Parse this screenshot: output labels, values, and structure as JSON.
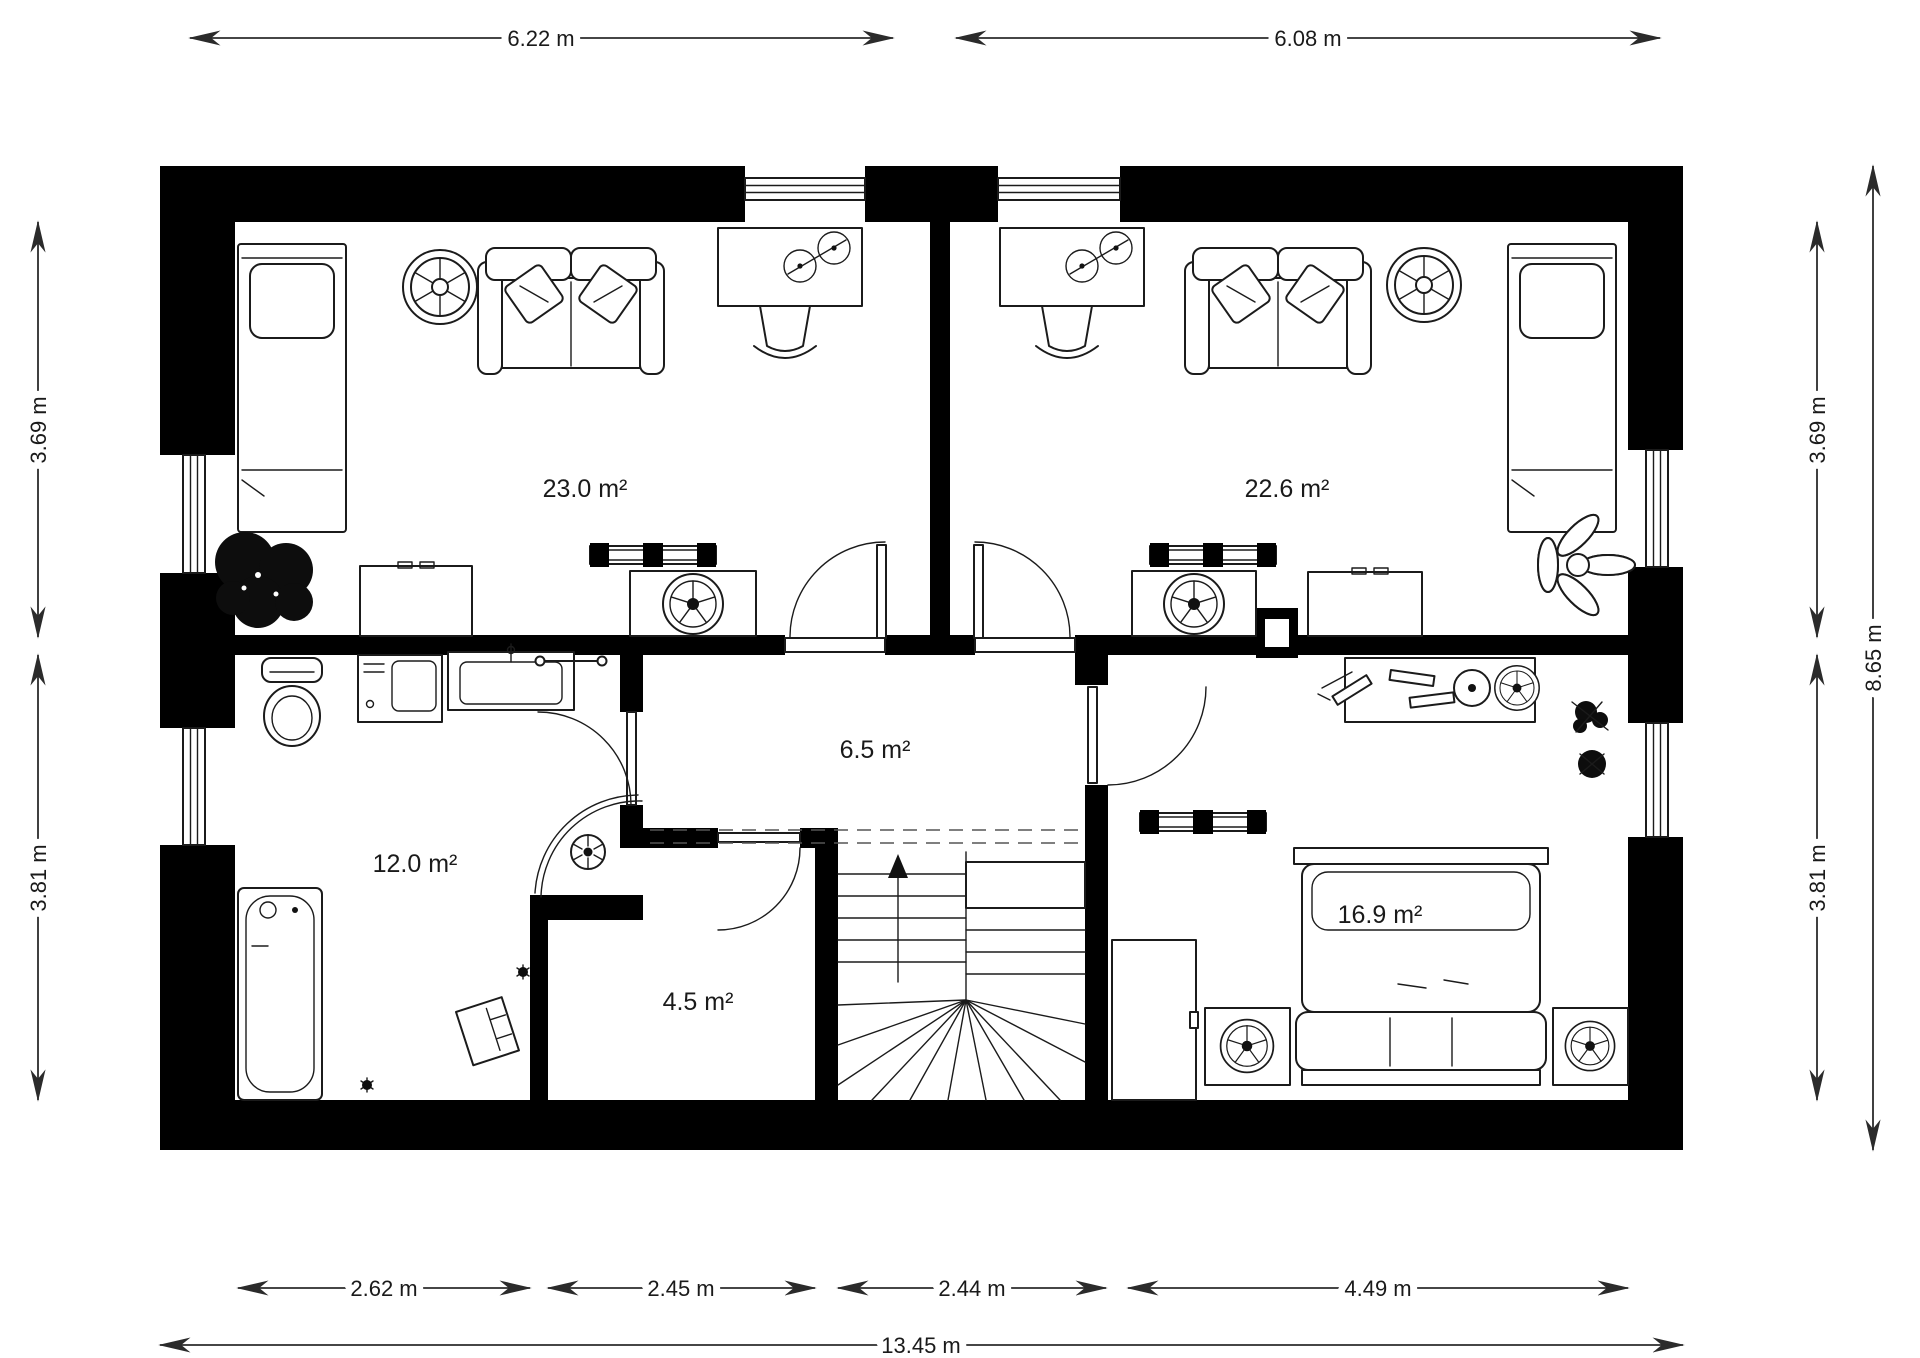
{
  "title": "Upper floor plan",
  "colors": {
    "wall": "#000000",
    "line": "#1b1b1b",
    "background": "#ffffff"
  },
  "rooms": [
    {
      "id": "bedroom-left",
      "area": "23.0 m²"
    },
    {
      "id": "bedroom-right",
      "area": "22.6 m²"
    },
    {
      "id": "bathroom",
      "area": "12.0 m²"
    },
    {
      "id": "hallway",
      "area": "6.5 m²"
    },
    {
      "id": "storage",
      "area": "4.5 m²"
    },
    {
      "id": "bedroom-bottom",
      "area": "16.9 m²"
    }
  ],
  "dimensions": {
    "top": [
      {
        "value": "6.22 m"
      },
      {
        "value": "6.08 m"
      }
    ],
    "bottom": [
      {
        "value": "2.62 m"
      },
      {
        "value": "2.45 m"
      },
      {
        "value": "2.44 m"
      },
      {
        "value": "4.49 m"
      }
    ],
    "bottom_total": "13.45 m",
    "left": [
      {
        "value": "3.69 m"
      },
      {
        "value": "3.81 m"
      }
    ],
    "right": [
      {
        "value": "3.69 m"
      },
      {
        "value": "3.81 m"
      }
    ],
    "right_total": "8.65 m"
  }
}
